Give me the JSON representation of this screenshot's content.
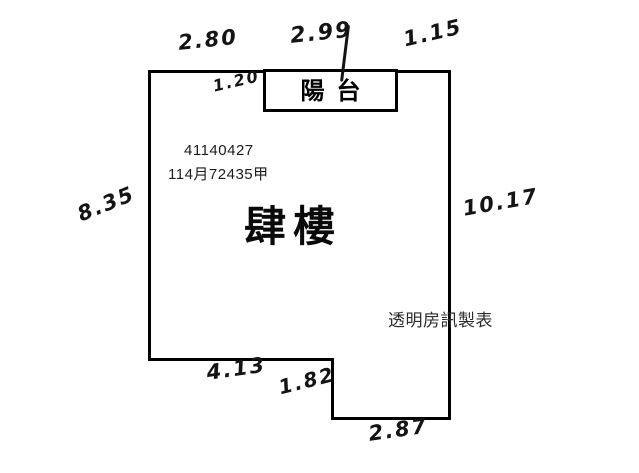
{
  "plan": {
    "unit_label": "肆樓",
    "balcony_label": "陽台",
    "ref_number": "41140427",
    "ref_code": "114月72435甲",
    "watermark": "透明房訊製表",
    "dims": {
      "top_left": "2.80",
      "top_mid": "2.99",
      "top_right": "1.15",
      "balcony_depth": "1.20",
      "left_side": "8.35",
      "right_side": "10.17",
      "bottom_left": "4.13",
      "step": "1.82",
      "bottom_right": "2.87"
    },
    "colors": {
      "wall_line": "#000000",
      "ink": "#141414",
      "background": "#ffffff"
    }
  }
}
